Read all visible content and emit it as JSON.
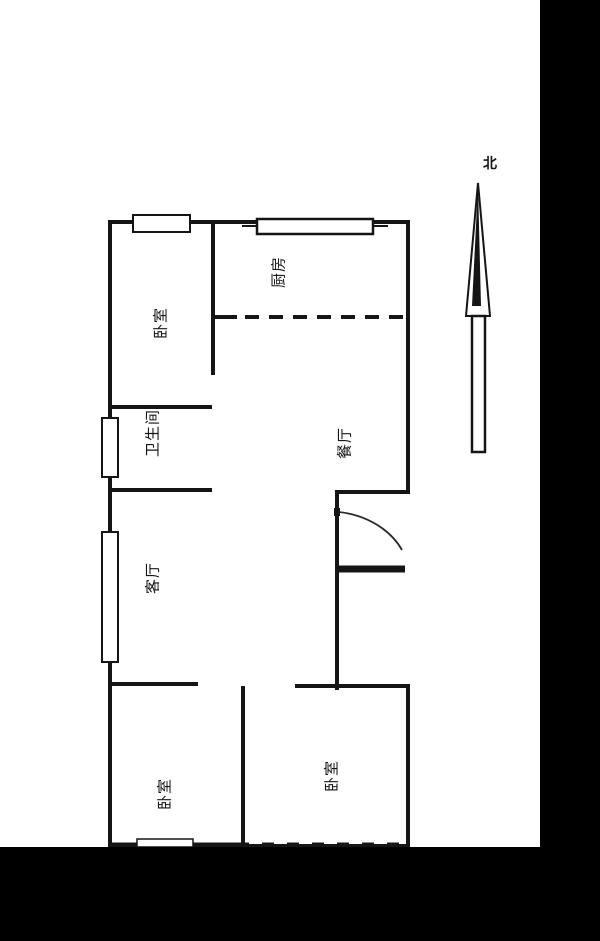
{
  "compass": {
    "label": "北"
  },
  "rooms": [
    {
      "id": "bedroom-northwest",
      "label": "卧室"
    },
    {
      "id": "kitchen",
      "label": "厨房"
    },
    {
      "id": "bathroom",
      "label": "卫生间"
    },
    {
      "id": "dining-room",
      "label": "餐厅"
    },
    {
      "id": "living-room",
      "label": "客厅"
    },
    {
      "id": "bedroom-southwest",
      "label": "卧室"
    },
    {
      "id": "bedroom-southeast",
      "label": "卧室"
    }
  ],
  "colors": {
    "line": "#151515",
    "background": "#ffffff",
    "matte": "#000000"
  }
}
